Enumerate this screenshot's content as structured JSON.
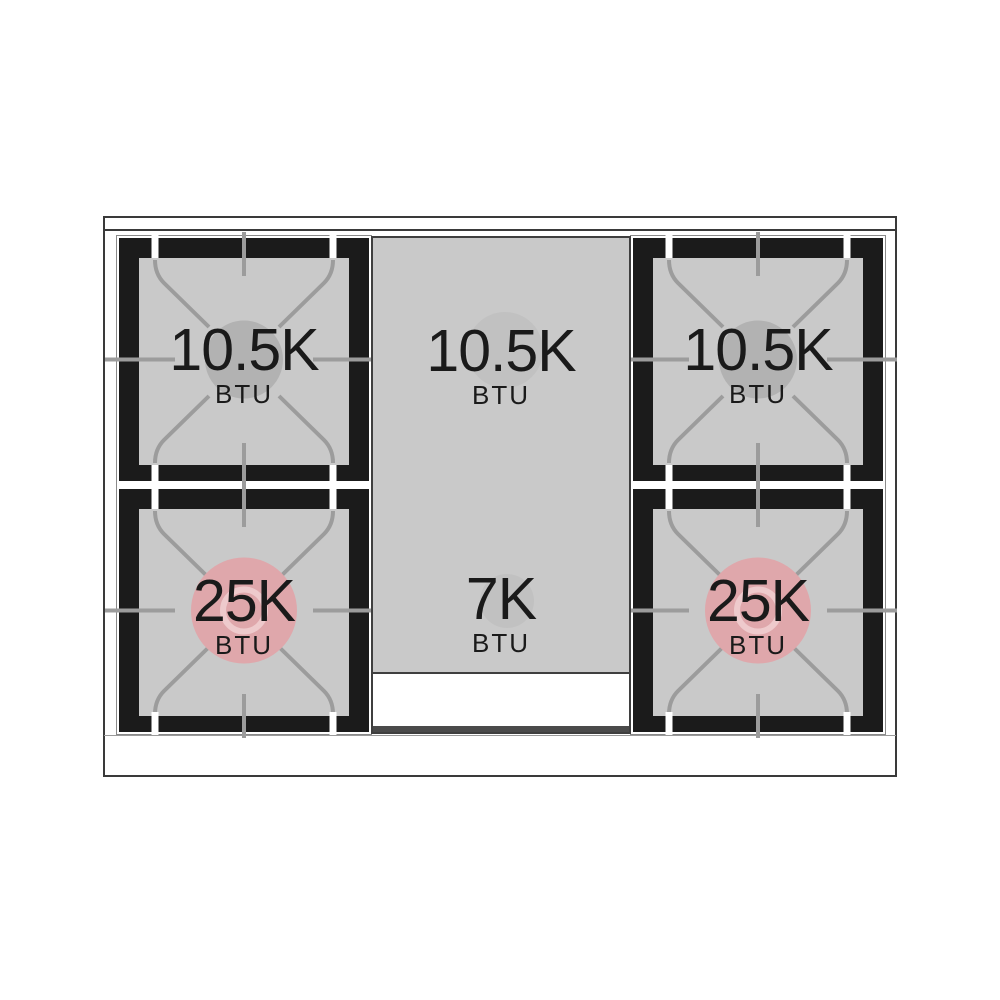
{
  "diagram_title": "Gas range cooktop burner BTU layout diagram",
  "colors": {
    "surface_gray": "#c9c9c9",
    "grate_black": "#1b1b1b",
    "grate_line_gray": "#9c9c9c",
    "slit_white": "#ffffff",
    "standard_cap_circle": "#b2b2b2",
    "center_cap_circle": "#c1c1c1",
    "power_cap_circle": "#dfa7ab",
    "power_cap_ring": "#eecacc",
    "text_color": "#1a1a1a"
  },
  "burners": {
    "top_left": {
      "value": "10.5K",
      "unit": "BTU"
    },
    "center_top": {
      "value": "10.5K",
      "unit": "BTU"
    },
    "top_right": {
      "value": "10.5K",
      "unit": "BTU"
    },
    "bottom_left": {
      "value": "25K",
      "unit": "BTU"
    },
    "center_bottom": {
      "value": "7K",
      "unit": "BTU"
    },
    "bottom_right": {
      "value": "25K",
      "unit": "BTU"
    }
  }
}
